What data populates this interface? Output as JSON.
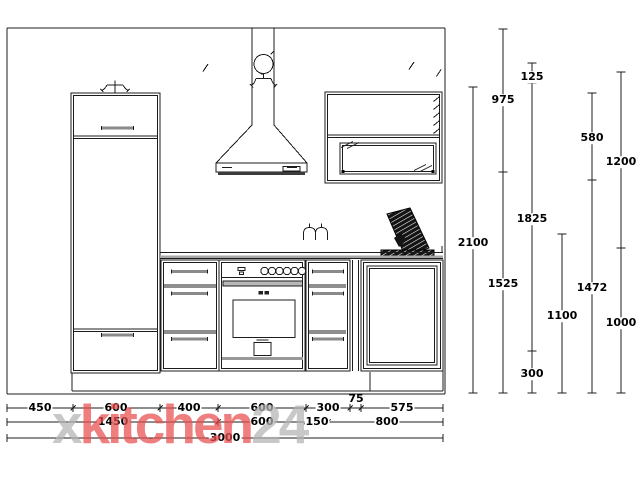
{
  "watermark": {
    "prefix": "x",
    "brand": "kitchen",
    "suffix": "24",
    "brand_color": "#e94f4f",
    "gray_color": "#b3b3b3"
  },
  "dims": {
    "vertical": [
      "2100",
      "975",
      "1525",
      "125",
      "1825",
      "300",
      "1100",
      "580",
      "1472",
      "1200",
      "1000"
    ],
    "row1": [
      "450",
      "600",
      "400",
      "600",
      "300",
      "75",
      "575"
    ],
    "row2": [
      "1450",
      "600",
      "150",
      "800"
    ],
    "row3": [
      "3000"
    ]
  },
  "line_color": "#1c1c1c"
}
